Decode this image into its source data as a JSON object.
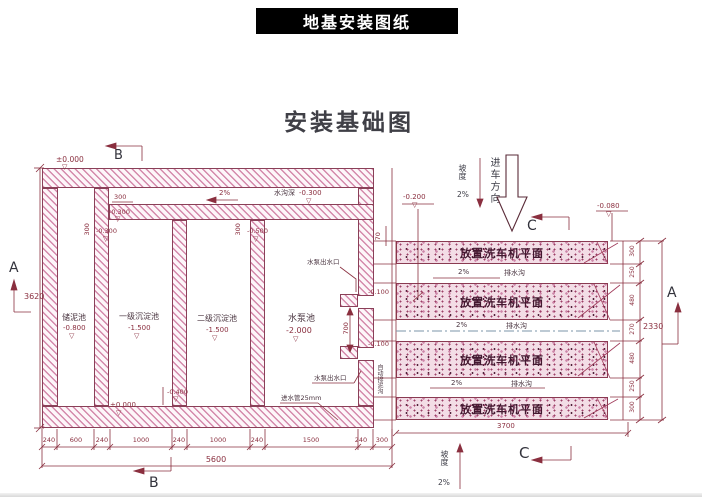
{
  "banner": {
    "title": "地基安装图纸"
  },
  "drawing": {
    "title": "安装基础图"
  },
  "symbols": {
    "level": "▽"
  },
  "markers": {
    "a_left": "A",
    "a_right": "A",
    "b_top": "B",
    "b_bottom": "B",
    "c_top": "C",
    "c_bottom": "C"
  },
  "tank": {
    "chambers": [
      {
        "name": "储泥池",
        "level": "-0.800"
      },
      {
        "name": "一级沉淀池",
        "level": "-1.500"
      },
      {
        "name": "二级沉淀池",
        "level": "-1.500"
      },
      {
        "name": "水泵池",
        "level": "-2.000"
      }
    ],
    "labels": {
      "zero_top": "±0.000",
      "zero_bottom": "±0.000",
      "channel_slope": "2%",
      "channel_name": "水沟深",
      "channel_level": "-0.300",
      "dim_300_h": "300",
      "level_a": "-0.300",
      "dim_300_v1": "300",
      "level_b": "-0.300",
      "dim_300_v2": "300",
      "level_c": "-0.500",
      "level_d": "-0.400",
      "pump_outlet_top": "水泵出水口",
      "pump_outlet_bottom": "水泵出水口",
      "inlet_pipe": "进水管25mm",
      "auto_mud": "自动排泥沟",
      "level_neg100_a": "-0.100",
      "level_neg100_b": "-0.100",
      "dim_700": "700",
      "dim_70": "70"
    },
    "dims": {
      "left_total": "3620",
      "bottom_chain": [
        "240",
        "600",
        "240",
        "1000",
        "240",
        "1000",
        "240",
        "1500",
        "240",
        "300"
      ],
      "bottom_total": "5600"
    }
  },
  "platform": {
    "bands": [
      "放置洗车机平面",
      "放置洗车机平面",
      "放置洗车机平面",
      "放置洗车机平面"
    ],
    "drains": [
      {
        "slope": "2%",
        "label": "排水沟"
      },
      {
        "slope": "2%",
        "label": "排水沟"
      },
      {
        "slope": "2%",
        "label": "排水沟"
      }
    ],
    "labels": {
      "level_neg200": "-0.200",
      "level_neg080": "-0.080",
      "slope_top": "坡度",
      "slope_top_val": "2%",
      "entry": "进车方向",
      "slope_bottom": "坡度",
      "slope_bottom_val": "2%"
    },
    "dims": {
      "right_chain": [
        "300",
        "250",
        "480",
        "270",
        "480",
        "250",
        "300"
      ],
      "right_total": "2330",
      "bottom_total": "3700"
    }
  },
  "colors": {
    "line": "#8a2f3f",
    "hatch": "#c86a8e",
    "stipple_base": "#f3dde6",
    "banner_bg": "#000000"
  }
}
